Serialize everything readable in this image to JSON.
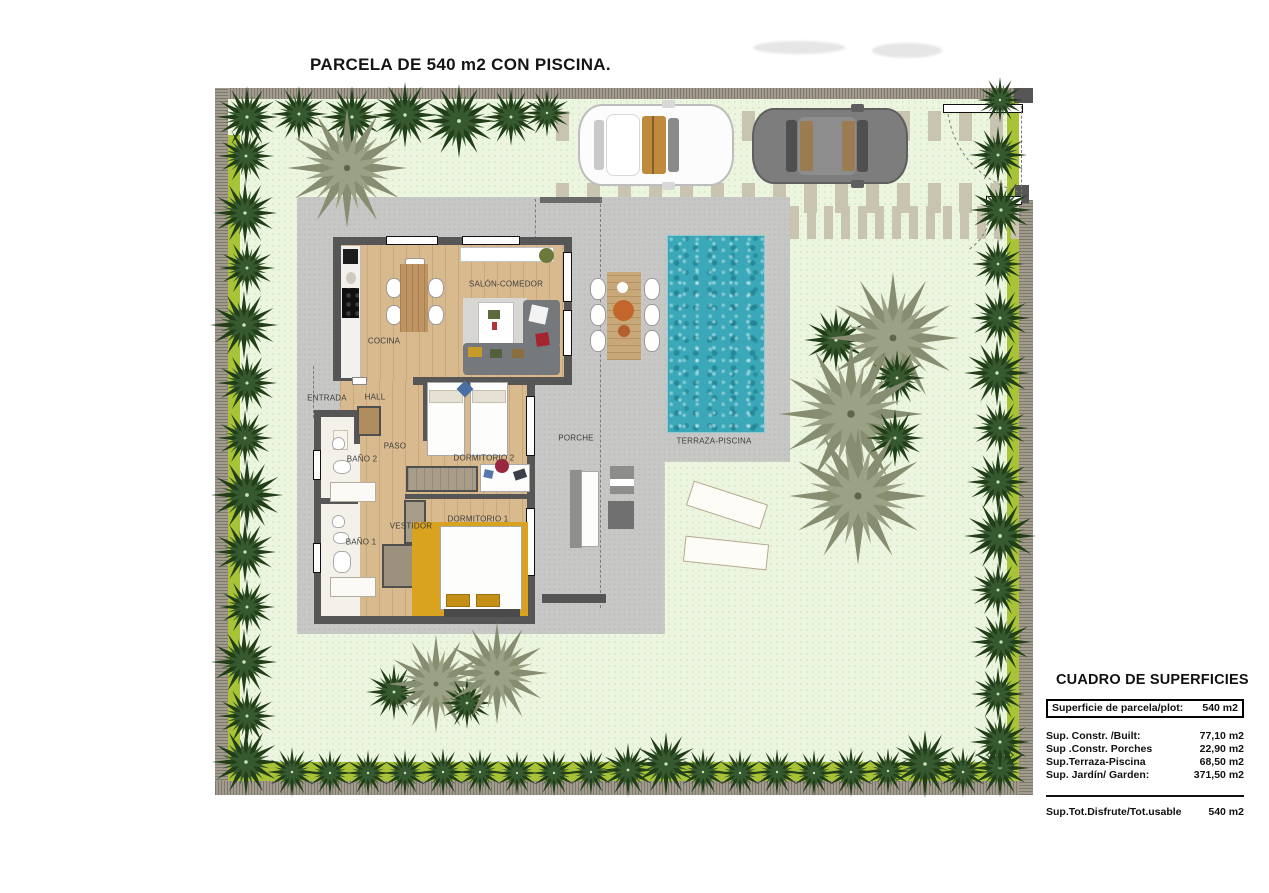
{
  "title": "PARCELA DE 540 m2 CON PISCINA.",
  "rooms": {
    "salon": "SALÓN-COMEDOR",
    "cocina": "COCINA",
    "entrada": "ENTRADA",
    "hall": "HALL",
    "paso": "PASO",
    "bano2": "BAÑO 2",
    "dormitorio2": "DORMITORIO 2",
    "porche": "PORCHE",
    "terraza": "TERRAZA-PISCINA",
    "vestidor": "VESTIDOR",
    "dormitorio1": "DORMITORIO 1",
    "bano1": "BAÑO 1"
  },
  "surfaces_table": {
    "title": "CUADRO DE SUPERFICIES",
    "plot_row": {
      "label": "Superficie de parcela/plot:",
      "value": "540 m2"
    },
    "rows": [
      {
        "label": "Sup. Constr. /Built:",
        "value": "77,10 m2"
      },
      {
        "label": "Sup .Constr. Porches",
        "value": "22,90 m2"
      },
      {
        "label": "Sup.Terraza-Piscina",
        "value": "68,50 m2"
      },
      {
        "label": "Sup. Jardín/ Garden:",
        "value": "371,50 m2"
      }
    ],
    "total_row": {
      "label": "Sup.Tot.Disfrute/Tot.usable",
      "value": "540 m2"
    }
  },
  "colors": {
    "lawn": "#ecf5df",
    "hedge": "#a9c337",
    "terrace": "#c7c7c5",
    "pool": "#3aa8b8",
    "wall": "#565656",
    "wood": "#d9ba8e",
    "ochre": "#d9a21f",
    "treedark": "#2c4a22",
    "treeolive": "#8b9176",
    "boundary": "#a29b8e"
  },
  "garden": {
    "trees": [
      {
        "x": 247,
        "y": 117,
        "s": 62,
        "t": "dark"
      },
      {
        "x": 299,
        "y": 114,
        "s": 56,
        "t": "dark"
      },
      {
        "x": 352,
        "y": 117,
        "s": 62,
        "t": "dark"
      },
      {
        "x": 405,
        "y": 115,
        "s": 66,
        "t": "dark"
      },
      {
        "x": 459,
        "y": 121,
        "s": 74,
        "t": "dark"
      },
      {
        "x": 511,
        "y": 117,
        "s": 58,
        "t": "dark"
      },
      {
        "x": 547,
        "y": 113,
        "s": 48,
        "t": "dark"
      },
      {
        "x": 246,
        "y": 156,
        "s": 56,
        "t": "dark"
      },
      {
        "x": 245,
        "y": 213,
        "s": 64,
        "t": "dark"
      },
      {
        "x": 247,
        "y": 268,
        "s": 56,
        "t": "dark"
      },
      {
        "x": 244,
        "y": 325,
        "s": 68,
        "t": "dark"
      },
      {
        "x": 247,
        "y": 383,
        "s": 60,
        "t": "dark"
      },
      {
        "x": 245,
        "y": 438,
        "s": 56,
        "t": "dark"
      },
      {
        "x": 247,
        "y": 495,
        "s": 72,
        "t": "dark"
      },
      {
        "x": 245,
        "y": 552,
        "s": 62,
        "t": "dark"
      },
      {
        "x": 247,
        "y": 607,
        "s": 56,
        "t": "dark"
      },
      {
        "x": 244,
        "y": 662,
        "s": 66,
        "t": "dark"
      },
      {
        "x": 247,
        "y": 716,
        "s": 58,
        "t": "dark"
      },
      {
        "x": 246,
        "y": 762,
        "s": 68,
        "t": "dark"
      },
      {
        "x": 292,
        "y": 772,
        "s": 50,
        "t": "dark"
      },
      {
        "x": 330,
        "y": 773,
        "s": 46,
        "t": "dark"
      },
      {
        "x": 368,
        "y": 773,
        "s": 46,
        "t": "dark"
      },
      {
        "x": 405,
        "y": 773,
        "s": 46,
        "t": "dark"
      },
      {
        "x": 443,
        "y": 772,
        "s": 48,
        "t": "dark"
      },
      {
        "x": 480,
        "y": 772,
        "s": 46,
        "t": "dark"
      },
      {
        "x": 517,
        "y": 773,
        "s": 44,
        "t": "dark"
      },
      {
        "x": 554,
        "y": 773,
        "s": 46,
        "t": "dark"
      },
      {
        "x": 591,
        "y": 772,
        "s": 46,
        "t": "dark"
      },
      {
        "x": 628,
        "y": 770,
        "s": 54,
        "t": "dark"
      },
      {
        "x": 666,
        "y": 764,
        "s": 64,
        "t": "dark"
      },
      {
        "x": 703,
        "y": 772,
        "s": 48,
        "t": "dark"
      },
      {
        "x": 740,
        "y": 773,
        "s": 46,
        "t": "dark"
      },
      {
        "x": 777,
        "y": 772,
        "s": 46,
        "t": "dark"
      },
      {
        "x": 814,
        "y": 773,
        "s": 46,
        "t": "dark"
      },
      {
        "x": 851,
        "y": 772,
        "s": 50,
        "t": "dark"
      },
      {
        "x": 888,
        "y": 771,
        "s": 46,
        "t": "dark"
      },
      {
        "x": 925,
        "y": 764,
        "s": 68,
        "t": "dark"
      },
      {
        "x": 963,
        "y": 772,
        "s": 50,
        "t": "dark"
      },
      {
        "x": 1000,
        "y": 768,
        "s": 58,
        "t": "dark"
      },
      {
        "x": 1000,
        "y": 100,
        "s": 46,
        "t": "dark"
      },
      {
        "x": 998,
        "y": 155,
        "s": 58,
        "t": "dark"
      },
      {
        "x": 1001,
        "y": 210,
        "s": 62,
        "t": "dark"
      },
      {
        "x": 998,
        "y": 264,
        "s": 52,
        "t": "dark"
      },
      {
        "x": 1000,
        "y": 318,
        "s": 60,
        "t": "dark"
      },
      {
        "x": 997,
        "y": 373,
        "s": 66,
        "t": "dark"
      },
      {
        "x": 1000,
        "y": 428,
        "s": 56,
        "t": "dark"
      },
      {
        "x": 998,
        "y": 482,
        "s": 62,
        "t": "dark"
      },
      {
        "x": 1000,
        "y": 536,
        "s": 72,
        "t": "dark"
      },
      {
        "x": 998,
        "y": 590,
        "s": 56,
        "t": "dark"
      },
      {
        "x": 1001,
        "y": 642,
        "s": 62,
        "t": "dark"
      },
      {
        "x": 998,
        "y": 694,
        "s": 54,
        "t": "dark"
      },
      {
        "x": 1000,
        "y": 742,
        "s": 60,
        "t": "dark"
      },
      {
        "x": 347,
        "y": 168,
        "s": 120,
        "t": "olive"
      },
      {
        "x": 836,
        "y": 340,
        "s": 64,
        "t": "dark"
      },
      {
        "x": 893,
        "y": 338,
        "s": 132,
        "t": "olive"
      },
      {
        "x": 897,
        "y": 378,
        "s": 56,
        "t": "dark"
      },
      {
        "x": 851,
        "y": 414,
        "s": 144,
        "t": "olive"
      },
      {
        "x": 895,
        "y": 438,
        "s": 58,
        "t": "dark"
      },
      {
        "x": 858,
        "y": 496,
        "s": 138,
        "t": "olive"
      },
      {
        "x": 394,
        "y": 692,
        "s": 56,
        "t": "dark"
      },
      {
        "x": 436,
        "y": 684,
        "s": 98,
        "t": "olive"
      },
      {
        "x": 467,
        "y": 703,
        "s": 52,
        "t": "dark"
      },
      {
        "x": 497,
        "y": 673,
        "s": 102,
        "t": "olive"
      }
    ]
  }
}
